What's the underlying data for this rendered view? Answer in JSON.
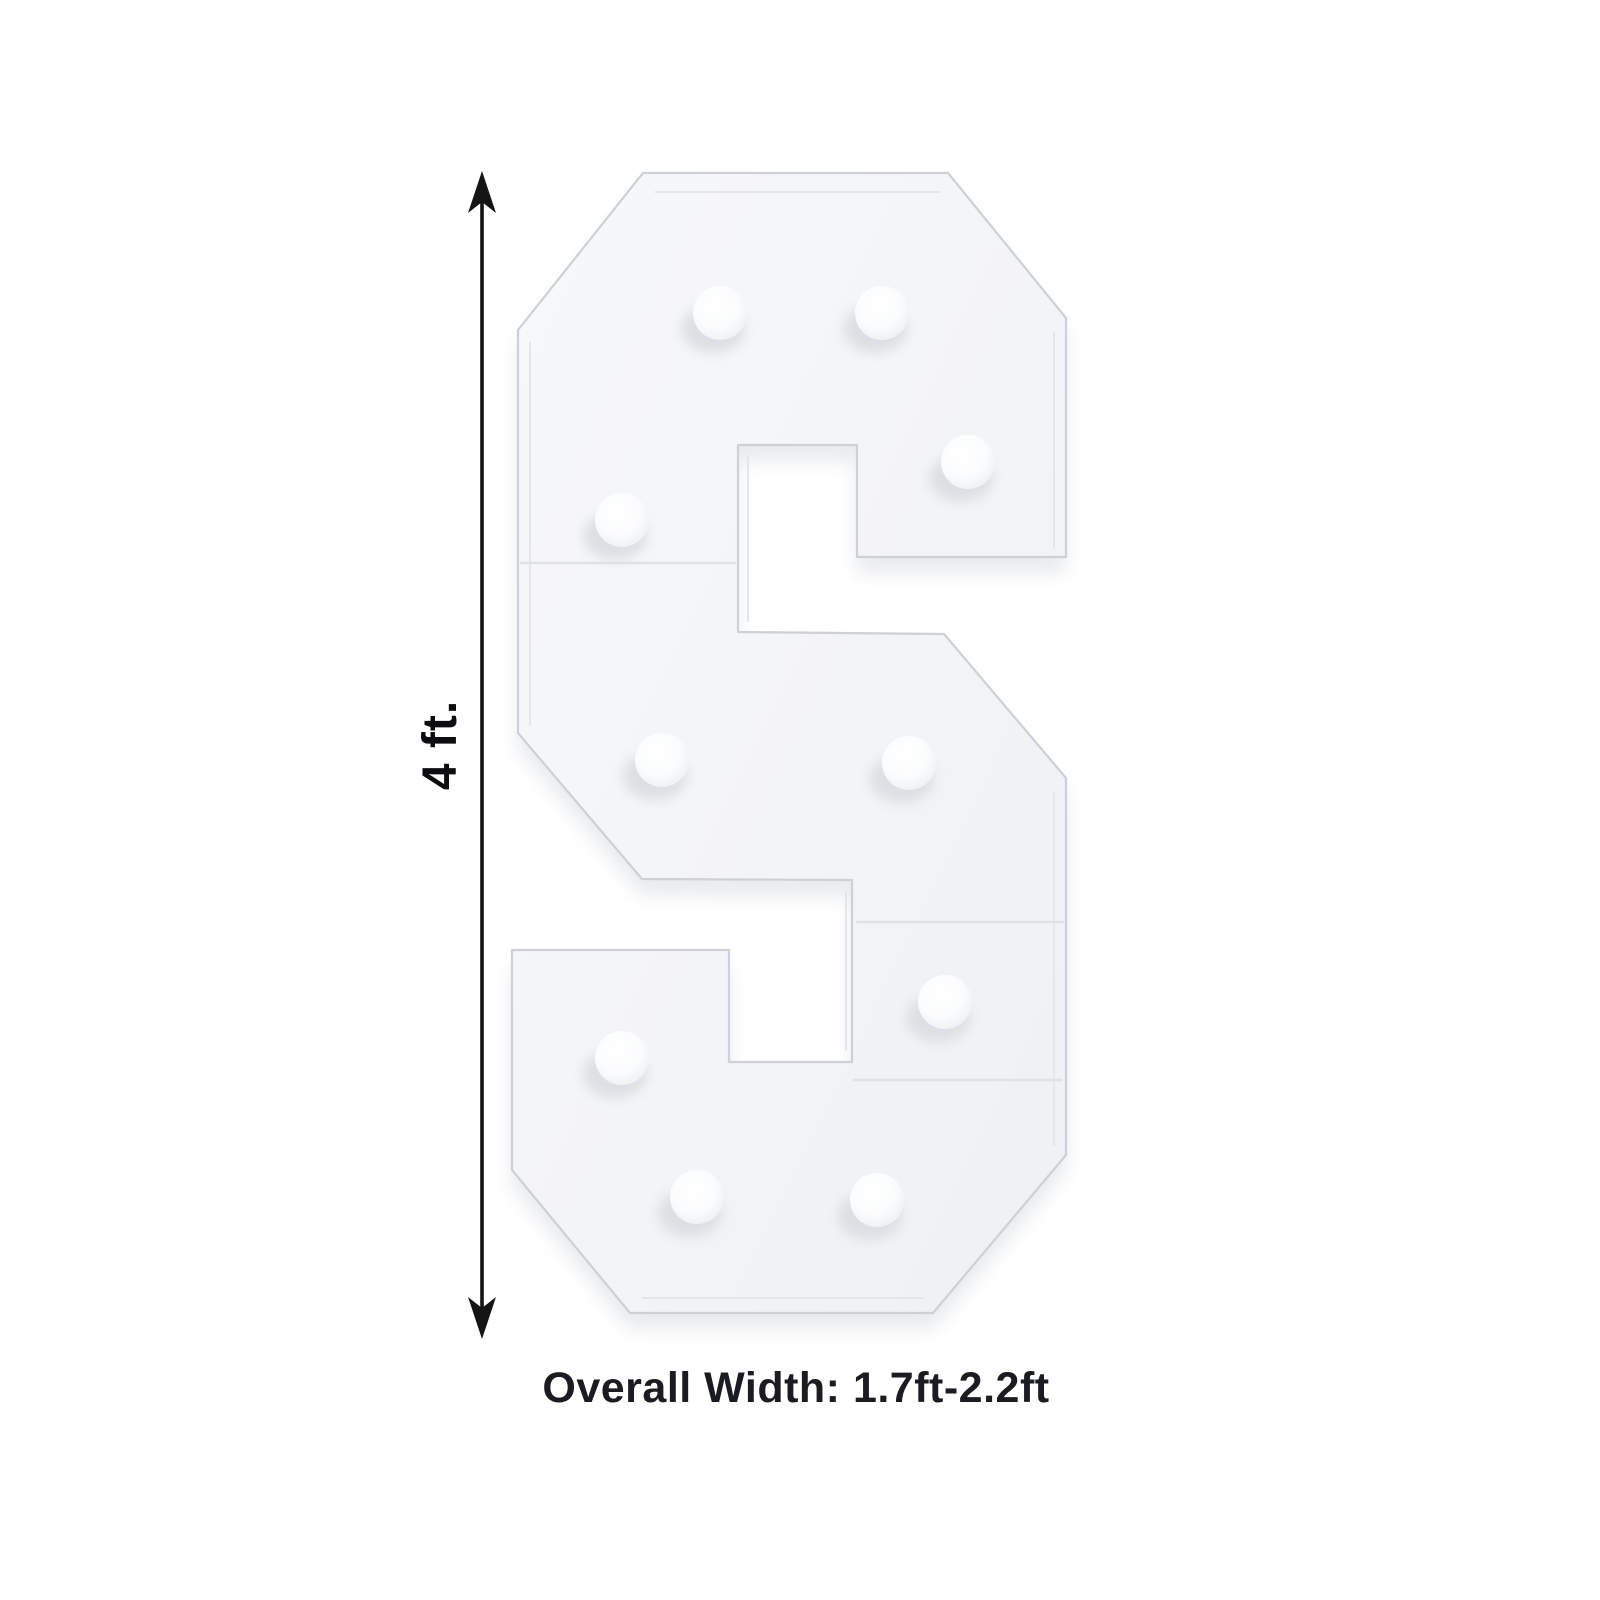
{
  "page": {
    "background_color": "#ffffff"
  },
  "figure": {
    "letter": {
      "character": "S",
      "type": "marquee-light-up-frame",
      "face_color": "#f4f5f7",
      "outline_color": "#cdd0d5",
      "bulb_count": 10
    },
    "dimensions": {
      "height_label": "4 ft.",
      "width_caption": "Overall Width: 1.7ft-2.2ft",
      "arrow_color": "#141414",
      "height_label_color": "#0d0d0f",
      "caption_color": "#1b1b22"
    }
  }
}
